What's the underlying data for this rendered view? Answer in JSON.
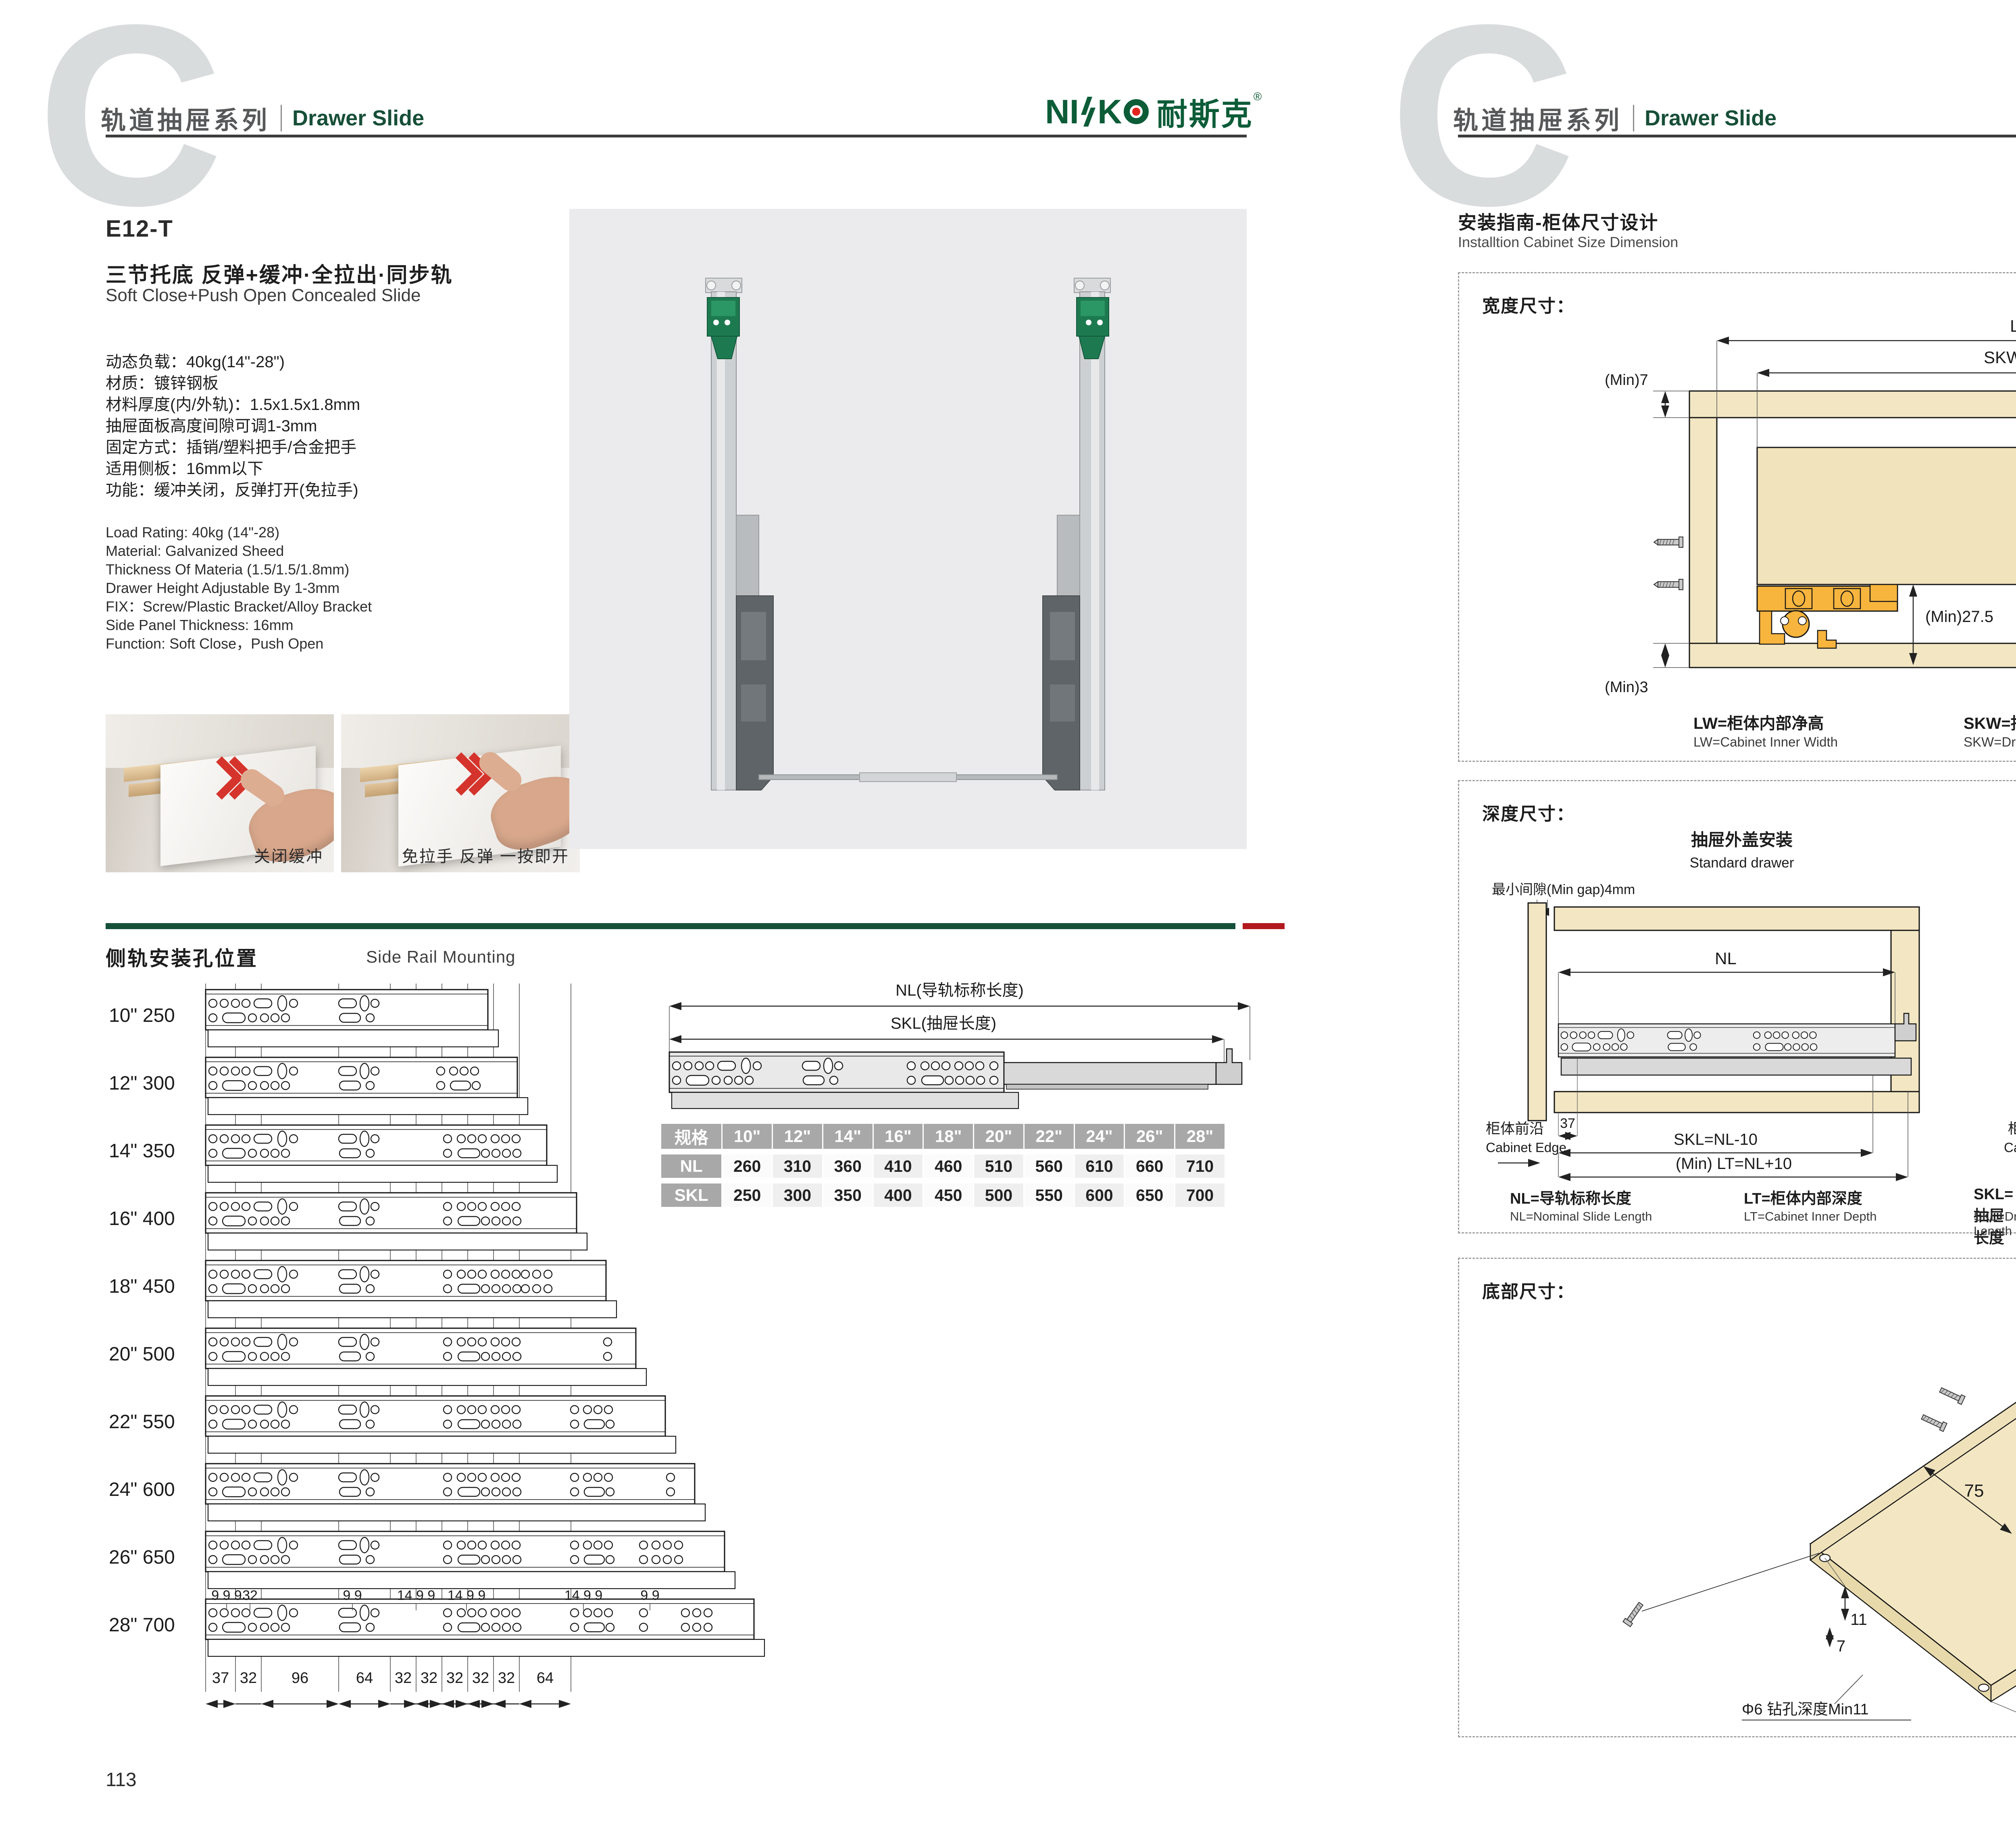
{
  "colors": {
    "accent_green": "#15503a",
    "accent_red": "#b2191f",
    "logo_green": "#0c5c38",
    "logo_red": "#e3231e",
    "wood": "#f3e7c3",
    "wood_dark": "#e8d9ab",
    "hardware_orange": "#f7b53e",
    "photo_bg": "#ebebed",
    "table_gray": "#a8a8a8",
    "watermark_gray": "#d9dcdd"
  },
  "header": {
    "watermark_letter": "C",
    "series_cn": "轨道抽屉系列",
    "series_en": "Drawer Slide",
    "brand_n1": "NI",
    "brand_k": "K",
    "brand_cn": "耐斯克",
    "reg": "®"
  },
  "left_page": {
    "model": "E12-T",
    "title_cn": "三节托底 反弹+缓冲·全拉出·同步轨",
    "title_en": "Soft Close+Push Open Concealed Slide",
    "specs_cn": [
      "动态负载：40kg(14\"-28\")",
      "材质：镀锌钢板",
      "材料厚度(内/外轨)：1.5x1.5x1.8mm",
      "抽屉面板高度间隙可调1-3mm",
      "固定方式：插销/塑料把手/合金把手",
      "适用侧板：16mm以下",
      "功能：缓冲关闭，反弹打开(免拉手)"
    ],
    "specs_en": [
      "Load Rating: 40kg (14\"-28)",
      "Material: Galvanized Sheed",
      "Thickness Of Materia (1.5/1.5/1.8mm)",
      "Drawer Height Adjustable By 1-3mm",
      "FIX：Screw/Plastic Bracket/Alloy Bracket",
      "Side Panel Thickness: 16mm",
      "Function: Soft Close，Push Open"
    ],
    "photos": [
      {
        "caption": "关闭缓冲"
      },
      {
        "caption": "免拉手 反弹 一按即开"
      }
    ],
    "rail_section": {
      "title_cn": "侧轨安装孔位置",
      "title_en": "Side Rail Mounting",
      "rows": [
        {
          "inch": "10\"",
          "mm": 250
        },
        {
          "inch": "12\"",
          "mm": 300
        },
        {
          "inch": "14\"",
          "mm": 350
        },
        {
          "inch": "16\"",
          "mm": 400
        },
        {
          "inch": "18\"",
          "mm": 450
        },
        {
          "inch": "20\"",
          "mm": 500
        },
        {
          "inch": "22\"",
          "mm": 550
        },
        {
          "inch": "24\"",
          "mm": 600
        },
        {
          "inch": "26\"",
          "mm": 650
        },
        {
          "inch": "28\"",
          "mm": 700
        }
      ],
      "top_dims": [
        "9 9 9",
        "32",
        "9 9",
        "14 9 9",
        "14 9 9",
        "14 9 9",
        "9 9"
      ],
      "bottom_dims": [
        "37",
        "32",
        "96",
        "64",
        "32",
        "32",
        "32",
        "32",
        "32",
        "64"
      ]
    },
    "nl_diagram": {
      "nl_label": "NL(导轨标称长度)",
      "skl_label": "SKL(抽屉长度)"
    },
    "size_table": {
      "spec_header": "规格",
      "sizes": [
        "10\"",
        "12\"",
        "14\"",
        "16\"",
        "18\"",
        "20\"",
        "22\"",
        "24\"",
        "26\"",
        "28\""
      ],
      "nl_label": "NL",
      "nl": [
        "260",
        "310",
        "360",
        "410",
        "460",
        "510",
        "560",
        "610",
        "660",
        "710"
      ],
      "skl_label": "SKL",
      "skl": [
        "250",
        "300",
        "350",
        "400",
        "450",
        "500",
        "550",
        "600",
        "650",
        "700"
      ]
    },
    "page_no": "113"
  },
  "right_page": {
    "guide_title_cn": "安装指南-柜体尺寸设计",
    "guide_title_en": "Installtion Cabinet Size Dimension",
    "width_section": {
      "title": "宽度尺寸：",
      "dims": {
        "lw": "LW",
        "skw": "SKW=LW-42",
        "min7": "(Min)7",
        "min3": "(Min)3",
        "max16": "(Max)16",
        "d12": "12",
        "d10": "10",
        "d37": "37",
        "min275": "(Min)27.5",
        "d21": "21"
      },
      "legend": [
        {
          "cn": "LW=柜体内部净高",
          "en": "LW=Cabinet Inner Width"
        },
        {
          "cn": "SKW=抽屉宽度",
          "en": "SKW=Drawer  Width"
        },
        {
          "cn": "最大尺寸",
          "en": "Max"
        },
        {
          "cn": "最小尺寸",
          "en": "Min"
        }
      ]
    },
    "depth_section": {
      "title": "深度尺寸：",
      "std": {
        "title_cn": "抽屉外盖安装",
        "title_en": "Standard drawer",
        "min_gap": "最小间隙(Min gap)4mm",
        "nl": "NL",
        "d37": "37",
        "skl": "SKL=NL-10",
        "lt": "(Min) LT=NL+10",
        "edge_cn": "柜体前沿",
        "edge_en": "Cabinet Edge"
      },
      "builtin": {
        "title_cn": "抽屉内置安装",
        "title_en": "Built-in drawer",
        "x": "X",
        "nl": "NL",
        "iskl": "ISKL=SKL+X",
        "lt": "(Min) LT=NL+X+10",
        "edge_cn": "柜体前沿",
        "edge_en": "Cabinet Edge"
      },
      "legend": [
        {
          "cn": "NL=导轨标称长度",
          "en": "NL=Nominal Slide Length"
        },
        {
          "cn": "LT=柜体内部深度",
          "en": "LT=Cabinet Inner Depth"
        },
        {
          "cn": "SKL=抽屉长度",
          "en": "SKL=Drawer Length"
        },
        {
          "cn": "ISKL=内抽屉长度",
          "en": "ISKL=Drawer Inner Length"
        },
        {
          "cn": "X=抽屉面板厚度",
          "en": "X=Drawer Panel Thickness"
        }
      ]
    },
    "bottom_section": {
      "title": "底部尺寸：",
      "d75": "75",
      "d85": "85",
      "d11": "11",
      "d7": "7",
      "hole": "Φ6 钻孔深度Min11",
      "diag": "抽屉长度SKL=导轨标称长度NL-10"
    },
    "page_no": "114"
  }
}
